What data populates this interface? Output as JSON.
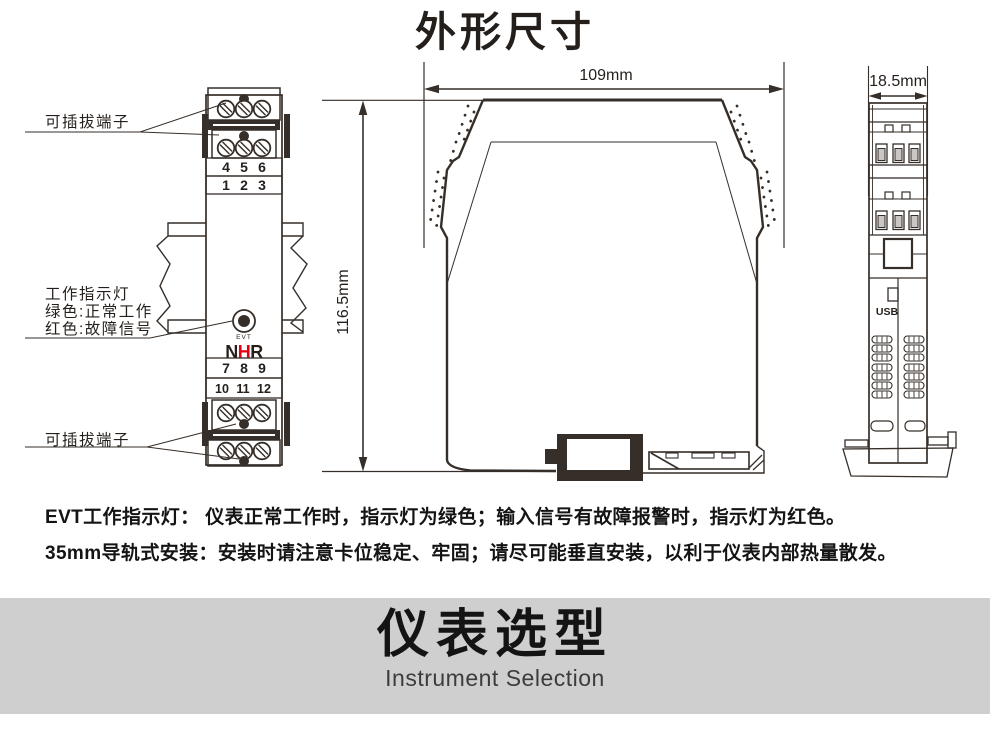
{
  "page": {
    "title": "外形尺寸"
  },
  "front_view": {
    "top_terminal_label": "可插拔端子",
    "indicator_lines": [
      "工作指示灯",
      "绿色:正常工作",
      "红色:故障信号"
    ],
    "bottom_terminal_label": "可插拔端子",
    "evt_label": "EVT",
    "logo_n": "N",
    "logo_h": "H",
    "logo_r": "R",
    "terminal_row_456": [
      "4",
      "5",
      "6"
    ],
    "terminal_row_123": [
      "1",
      "2",
      "3"
    ],
    "terminal_row_789": [
      "7",
      "8",
      "9"
    ],
    "terminal_row_101112": [
      "10",
      "11",
      "12"
    ]
  },
  "side_view": {
    "width_label": "109mm",
    "height_label": "116.5mm"
  },
  "end_view": {
    "width_label": "18.5mm",
    "usb_label": "USB"
  },
  "notes": {
    "line1": "EVT工作指示灯： 仪表正常工作时，指示灯为绿色；输入信号有故障报警时，指示灯为红色。",
    "line2": "35mm导轨式安装：安装时请注意卡位稳定、牢固；请尽可能垂直安装，以利于仪表内部热量散发。"
  },
  "banner": {
    "title": "仪表选型",
    "subtitle": "Instrument Selection"
  },
  "colors": {
    "line": "#362e28",
    "red": "#e60012",
    "banner_bg": "#d0cfcf",
    "slot_gray": "#c9c6c3"
  }
}
